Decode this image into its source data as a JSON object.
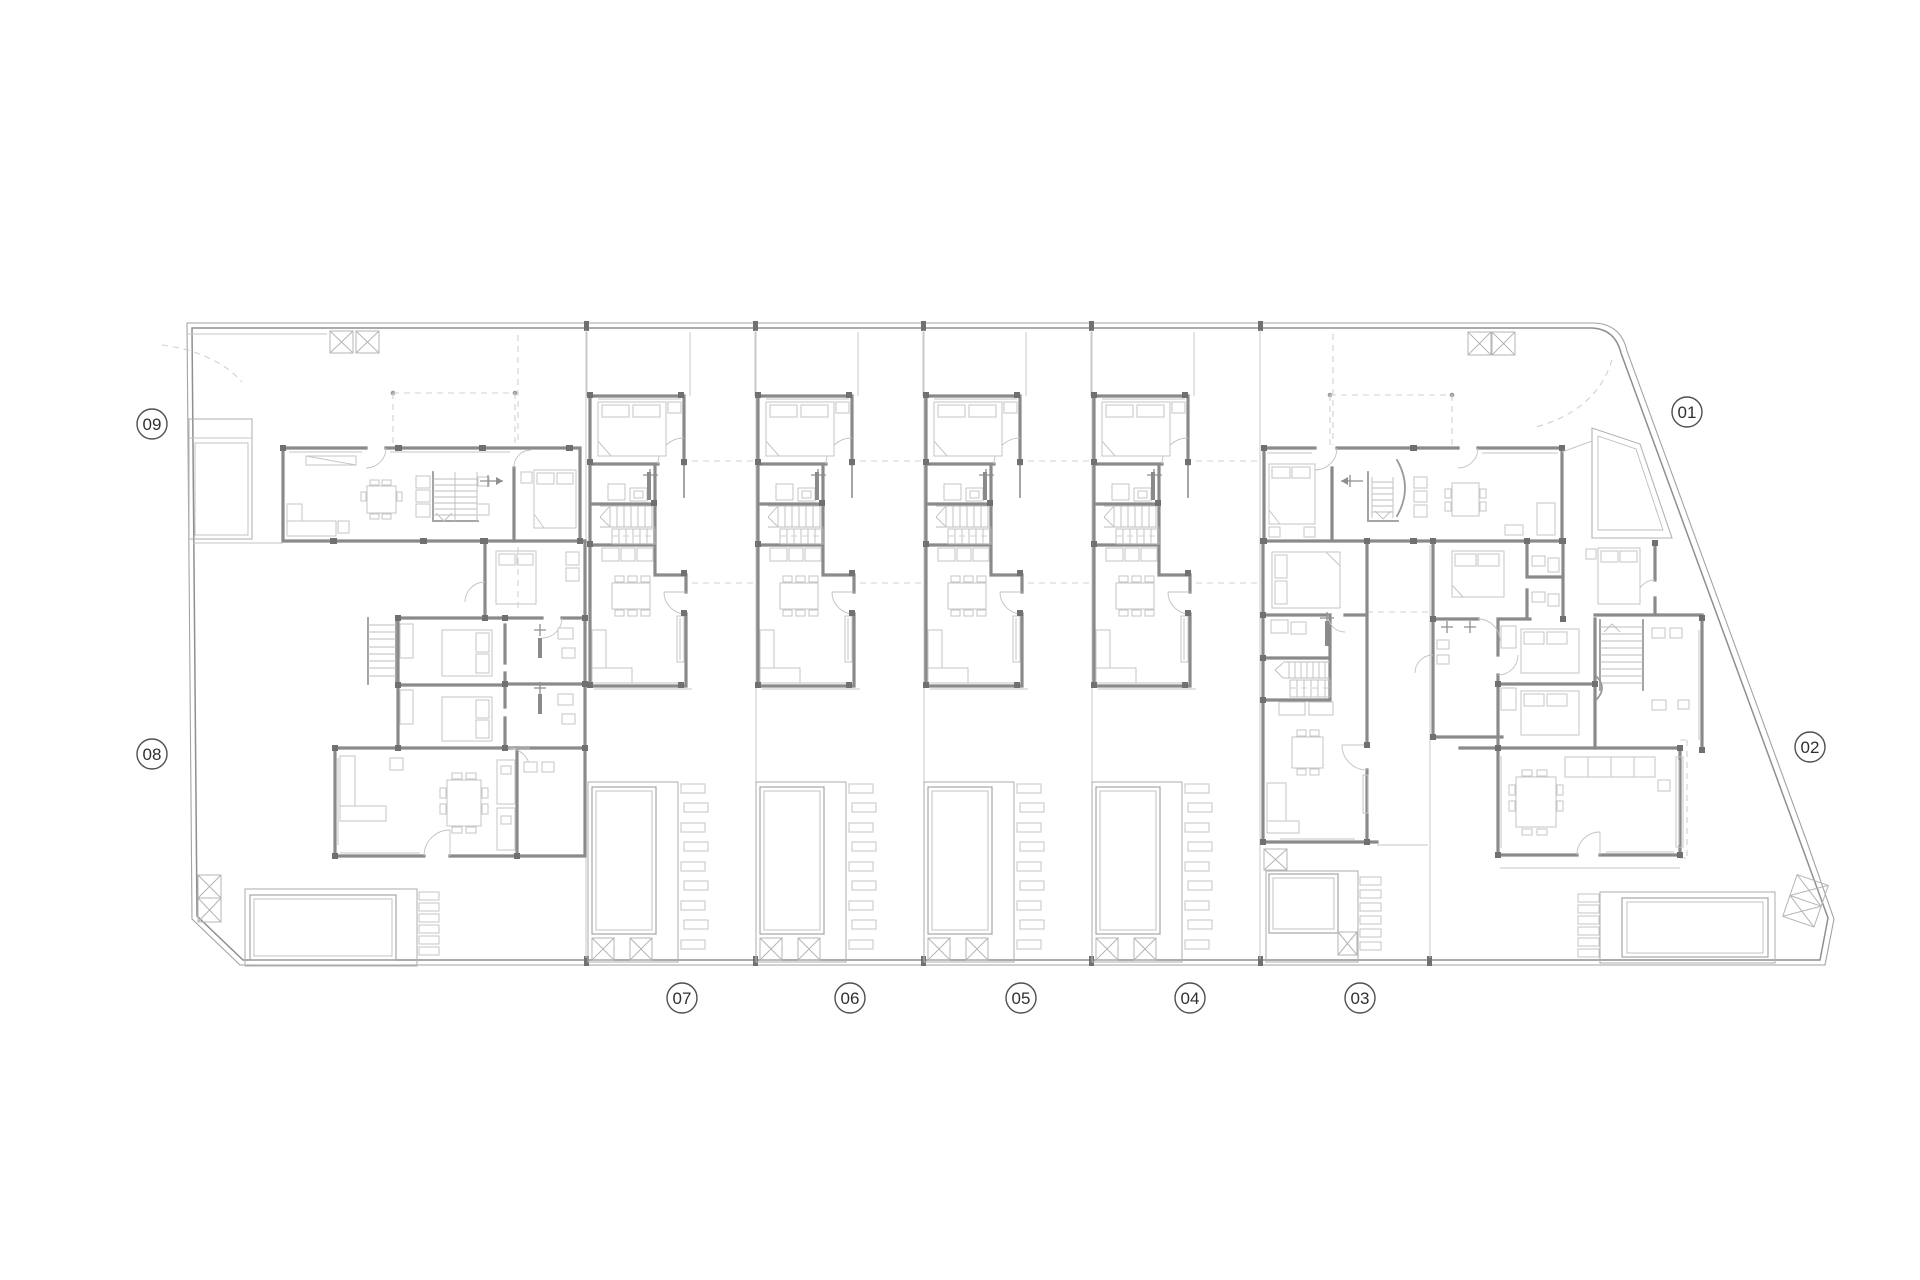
{
  "plan": {
    "type": "residential-site-floor-plan",
    "unit_count": 9,
    "units": [
      {
        "id": "unit-01",
        "label": "01"
      },
      {
        "id": "unit-02",
        "label": "02"
      },
      {
        "id": "unit-03",
        "label": "03"
      },
      {
        "id": "unit-04",
        "label": "04"
      },
      {
        "id": "unit-05",
        "label": "05"
      },
      {
        "id": "unit-06",
        "label": "06"
      },
      {
        "id": "unit-07",
        "label": "07"
      },
      {
        "id": "unit-08",
        "label": "08"
      },
      {
        "id": "unit-09",
        "label": "09"
      }
    ]
  },
  "colors": {
    "background": "#ffffff",
    "wall": "#8a8a8a",
    "wall_light": "#9a9a9a",
    "furniture": "#c6c6c6",
    "fixture_dark": "#8a8a8a",
    "boundary": "#a3a3a3",
    "boundary_strong": "#8f8f8f",
    "dashed": "#d0d0d0",
    "pool": "#a6a6a6",
    "pool_light": "#bdbdbd",
    "lot_line": "#c9c9c9",
    "node": "#707070",
    "label_ring": "#4f4f4f",
    "label_text": "#2f2f2f"
  }
}
